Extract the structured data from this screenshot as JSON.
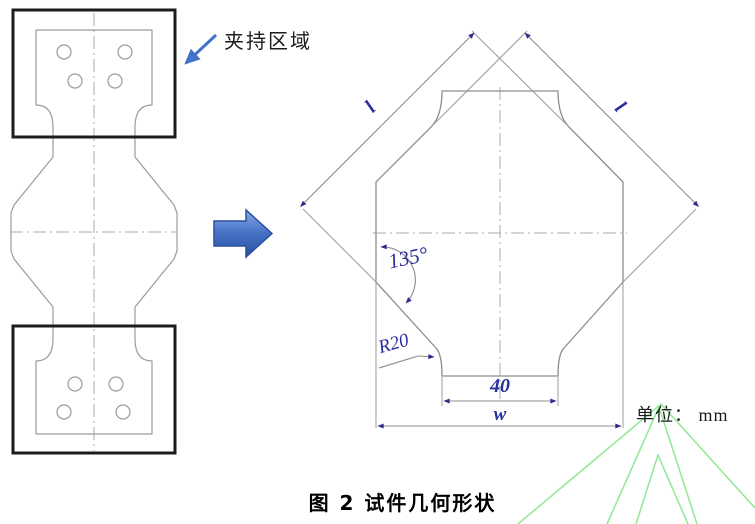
{
  "figure": {
    "caption": "图 2 试件几何形状",
    "clamp_region_label": "夹持区域",
    "unit_label": "单位： mm",
    "dimensions": {
      "corner_angle": "135°",
      "fillet_radius": "R20",
      "gauge_width": "40",
      "overall_width": "w",
      "side_length_left": "l",
      "side_length_right": "l"
    },
    "colors": {
      "dimension_text": "#2a2f9e",
      "dimension_line": "#8c8c8c",
      "specimen_outline": "#9b9b9b",
      "centerline": "#a9a9b4",
      "clamp_box": "#1c1c1c",
      "annotation_arrow": "#4273c9",
      "dimension_arrowhead": "#2d2d8f",
      "watermark_green": "#90e890"
    }
  }
}
